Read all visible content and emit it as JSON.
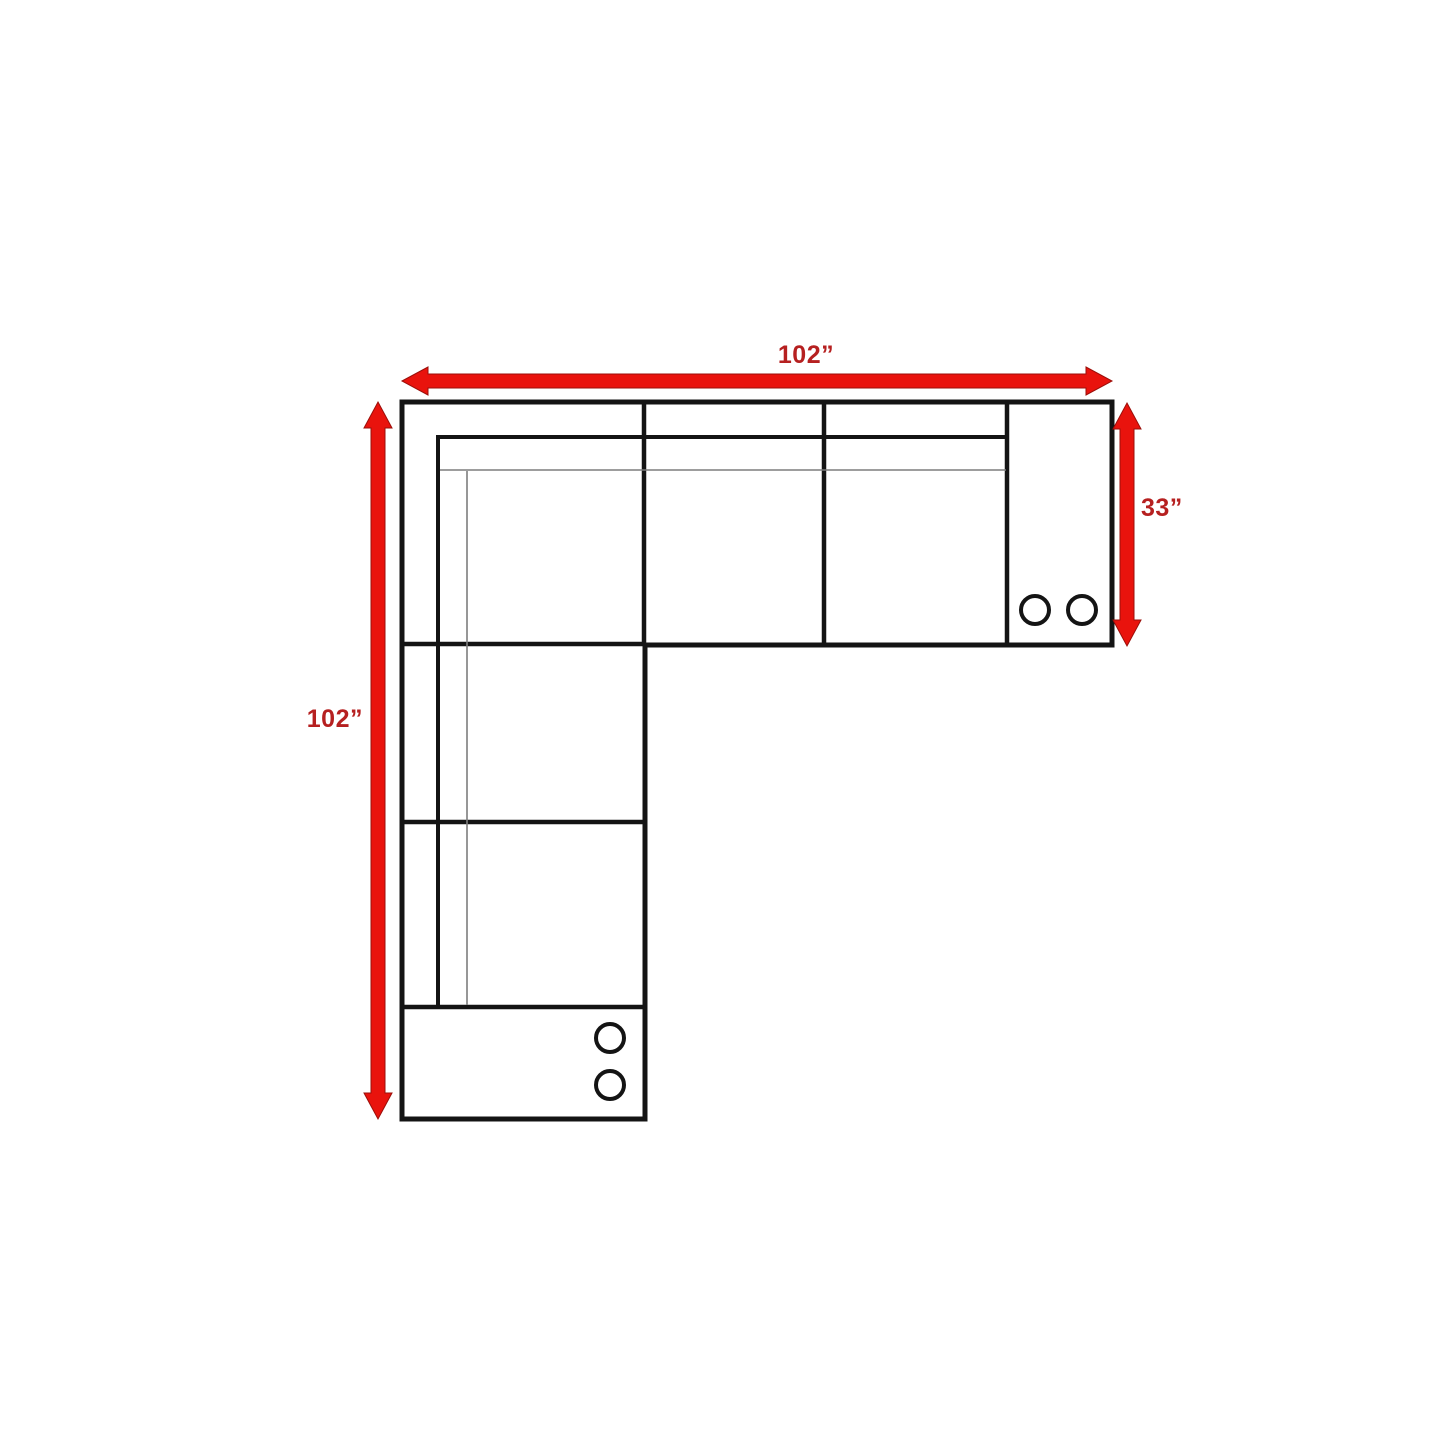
{
  "diagram": {
    "type": "sectional-sofa-floorplan",
    "colors": {
      "background": "#ffffff",
      "arrow_fill": "#e9130d",
      "arrow_edge": "#9b0f0a",
      "label_text": "#b62020",
      "outline": "#141414",
      "thin_line": "#7d7d7d"
    },
    "dimensions": {
      "top": {
        "label": "102”",
        "meaning": "overall width"
      },
      "left": {
        "label": "102”",
        "meaning": "overall depth"
      },
      "right": {
        "label": "33”",
        "meaning": "section depth"
      }
    },
    "cupholders": {
      "right_console": 2,
      "bottom_console": 2
    }
  }
}
